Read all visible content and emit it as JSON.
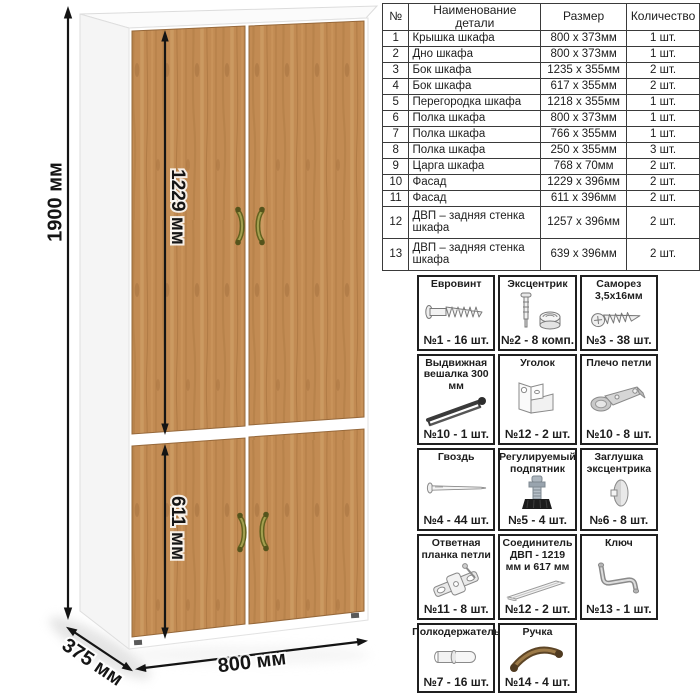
{
  "wardrobe": {
    "dimensions": {
      "height": "1900 мм",
      "upper_facade_height": "1229 мм",
      "lower_facade_height": "611 мм",
      "width": "800 мм",
      "depth": "375 мм"
    },
    "colors": {
      "wood": "#c28b53",
      "wood_dark": "#a9763f",
      "wood_light": "#d4a56c",
      "carcass": "#ffffff",
      "handle": "#6f6e2a",
      "dimension_line": "#141414"
    }
  },
  "parts_table": {
    "headers": [
      "№",
      "Наименование детали",
      "Размер",
      "Количество"
    ],
    "rows": [
      {
        "num": "1",
        "name": "Крышка шкафа",
        "size": "800 x 373мм",
        "qty": "1 шт."
      },
      {
        "num": "2",
        "name": "Дно шкафа",
        "size": "800 x 373мм",
        "qty": "1 шт."
      },
      {
        "num": "3",
        "name": "Бок шкафа",
        "size": "1235 x 355мм",
        "qty": "2 шт."
      },
      {
        "num": "4",
        "name": "Бок шкафа",
        "size": "617 x 355мм",
        "qty": "2 шт."
      },
      {
        "num": "5",
        "name": "Перегородка шкафа",
        "size": "1218 x 355мм",
        "qty": "1 шт."
      },
      {
        "num": "6",
        "name": "Полка шкафа",
        "size": "800 x 373мм",
        "qty": "1 шт."
      },
      {
        "num": "7",
        "name": "Полка шкафа",
        "size": "766 x 355мм",
        "qty": "1 шт."
      },
      {
        "num": "8",
        "name": "Полка шкафа",
        "size": "250 x 355мм",
        "qty": "3 шт."
      },
      {
        "num": "9",
        "name": "Царга шкафа",
        "size": "768 x 70мм",
        "qty": "2 шт."
      },
      {
        "num": "10",
        "name": "Фасад",
        "size": "1229 x 396мм",
        "qty": "2 шт."
      },
      {
        "num": "11",
        "name": "Фасад",
        "size": "611 x 396мм",
        "qty": "2 шт."
      },
      {
        "num": "12",
        "name": "ДВП – задняя стенка шкафа",
        "size": "1257 x 396мм",
        "qty": "2 шт."
      },
      {
        "num": "13",
        "name": "ДВП – задняя стенка шкафа",
        "size": "639 x 396мм",
        "qty": "2 шт."
      }
    ]
  },
  "hardware": {
    "items": [
      {
        "title": "Евровинт",
        "count": "№1 - 16 шт.",
        "icon": "euro-screw-icon"
      },
      {
        "title": "Эксцентрик",
        "count": "№2 - 8 комп.",
        "icon": "cam-lock-icon"
      },
      {
        "title": "Саморез 3,5х16мм",
        "count": "№3 - 38 шт.",
        "icon": "self-tapping-screw-icon"
      },
      {
        "title": "Выдвижная вешалка 300 мм",
        "count": "№10 - 1 шт.",
        "icon": "pull-out-hanger-icon"
      },
      {
        "title": "Уголок",
        "count": "№12 - 2 шт.",
        "icon": "corner-bracket-icon"
      },
      {
        "title": "Плечо петли",
        "count": "№10 - 8 шт.",
        "icon": "hinge-arm-icon"
      },
      {
        "title": "Гвоздь",
        "count": "№4 - 44 шт.",
        "icon": "nail-icon"
      },
      {
        "title": "Регулируемый подпятник",
        "count": "№5 - 4 шт.",
        "icon": "adjustable-foot-icon"
      },
      {
        "title": "Заглушка эксцентрика",
        "count": "№6 - 8 шт.",
        "icon": "cam-cover-icon"
      },
      {
        "title": "Ответная планка петли",
        "count": "№11 - 8 шт.",
        "icon": "hinge-plate-icon"
      },
      {
        "title": "Соединитель ДВП - 1219 мм и 617 мм",
        "count": "№12 - 2 шт.",
        "icon": "hdf-connector-icon"
      },
      {
        "title": "Ключ",
        "count": "№13 - 1 шт.",
        "icon": "hex-key-icon"
      },
      {
        "title": "Полкодержатель",
        "count": "№7 - 16 шт.",
        "icon": "shelf-pin-icon"
      },
      {
        "title": "Ручка",
        "count": "№14 - 4 шт.",
        "icon": "handle-icon"
      }
    ]
  }
}
